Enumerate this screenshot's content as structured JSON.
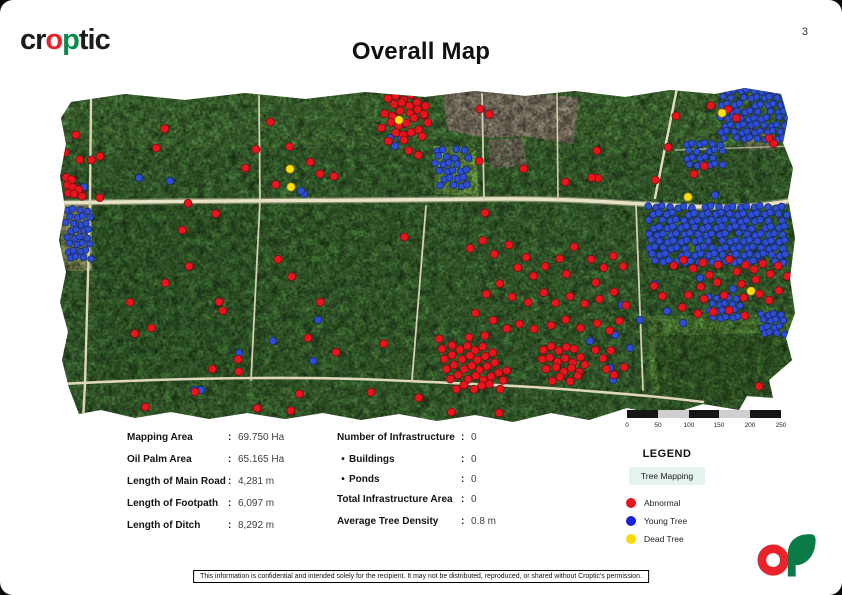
{
  "page": {
    "number": "3"
  },
  "header": {
    "logo": {
      "pre": "cr",
      "o": "o",
      "p": "p",
      "post": "tic"
    },
    "title": "Overall Map"
  },
  "ui": {
    "colon": ":",
    "bullet": "•"
  },
  "scalebar": {
    "labels": [
      "0",
      "50",
      "100",
      "150",
      "200",
      "250"
    ]
  },
  "stats_left": [
    {
      "label": "Mapping Area",
      "value": "69.750 Ha"
    },
    {
      "label": "Oil Palm Area",
      "value": "65.165 Ha"
    },
    {
      "label": "Length of Main Road",
      "value": "4,281 m"
    },
    {
      "label": "Length of Footpath",
      "value": "6,097 m"
    },
    {
      "label": "Length of Ditch",
      "value": "8,292 m"
    }
  ],
  "stats_right": [
    {
      "label": "Number of Infrastructure",
      "value": "0"
    },
    {
      "label": "Buildings",
      "value": "0"
    },
    {
      "label": "Ponds",
      "value": "0"
    },
    {
      "label": "Total Infrastructure Area",
      "value": "0"
    },
    {
      "label": "Average Tree Density",
      "value": "0.8 m"
    }
  ],
  "legend": {
    "title": "LEGEND",
    "group_label": "Tree Mapping",
    "group_bg": "#e4f3ee",
    "items": [
      {
        "label": "Abnormal",
        "color": "#e8151d"
      },
      {
        "label": "Young Tree",
        "color": "#1a22e0"
      },
      {
        "label": "Dead Tree",
        "color": "#ffd900"
      }
    ]
  },
  "footer": {
    "disclaimer": "This information is confidential and intended solely for the recipient. It may not be distributed, reproduced, or shared without Croptic's permission."
  },
  "map": {
    "colors": {
      "abnormal": "#e8151d",
      "abnormal_edge": "#7e0a0f",
      "young": "#2e4fd2",
      "young_edge": "#16277f",
      "dead": "#ffe10a",
      "dead_edge": "#c7a500"
    },
    "red": [
      [
        22,
        48
      ],
      [
        9,
        65
      ],
      [
        24,
        72
      ],
      [
        36,
        72
      ],
      [
        45,
        68
      ],
      [
        110,
        40
      ],
      [
        102,
        59
      ],
      [
        8,
        64
      ],
      [
        10,
        90
      ],
      [
        16,
        92
      ],
      [
        12,
        97
      ],
      [
        18,
        99
      ],
      [
        24,
        101
      ],
      [
        14,
        104
      ],
      [
        20,
        107
      ],
      [
        26,
        109
      ],
      [
        44,
        110
      ],
      [
        215,
        34
      ],
      [
        201,
        61
      ],
      [
        235,
        58
      ],
      [
        256,
        73
      ],
      [
        266,
        87
      ],
      [
        278,
        89
      ],
      [
        220,
        97
      ],
      [
        190,
        80
      ],
      [
        333,
        10
      ],
      [
        341,
        7
      ],
      [
        349,
        11
      ],
      [
        357,
        8
      ],
      [
        338,
        17
      ],
      [
        346,
        15
      ],
      [
        354,
        18
      ],
      [
        362,
        14
      ],
      [
        330,
        25
      ],
      [
        338,
        27
      ],
      [
        346,
        24
      ],
      [
        354,
        26
      ],
      [
        362,
        22
      ],
      [
        370,
        18
      ],
      [
        336,
        34
      ],
      [
        344,
        37
      ],
      [
        352,
        34
      ],
      [
        360,
        31
      ],
      [
        368,
        28
      ],
      [
        340,
        45
      ],
      [
        348,
        47
      ],
      [
        356,
        44
      ],
      [
        364,
        41
      ],
      [
        334,
        52
      ],
      [
        350,
        53
      ],
      [
        366,
        49
      ],
      [
        372,
        35
      ],
      [
        326,
        40
      ],
      [
        369,
        26
      ],
      [
        354,
        62
      ],
      [
        364,
        66
      ],
      [
        426,
        22
      ],
      [
        433,
        27
      ],
      [
        541,
        63
      ],
      [
        510,
        94
      ],
      [
        543,
        90
      ],
      [
        469,
        80
      ],
      [
        425,
        72
      ],
      [
        622,
        29
      ],
      [
        612,
        60
      ],
      [
        536,
        90
      ],
      [
        681,
        30
      ],
      [
        714,
        50
      ],
      [
        719,
        55
      ],
      [
        650,
        77
      ],
      [
        640,
        87
      ],
      [
        672,
        22
      ],
      [
        655,
        18
      ],
      [
        600,
        92
      ],
      [
        133,
        115
      ],
      [
        161,
        125
      ],
      [
        128,
        141
      ],
      [
        431,
        126
      ],
      [
        74,
        215
      ],
      [
        79,
        246
      ],
      [
        110,
        195
      ],
      [
        134,
        178
      ],
      [
        168,
        222
      ],
      [
        158,
        280
      ],
      [
        165,
        215
      ],
      [
        182,
        272
      ],
      [
        183,
        284
      ],
      [
        96,
        240
      ],
      [
        223,
        171
      ],
      [
        237,
        188
      ],
      [
        266,
        213
      ],
      [
        254,
        251
      ],
      [
        280,
        265
      ],
      [
        328,
        256
      ],
      [
        349,
        149
      ],
      [
        415,
        160
      ],
      [
        428,
        152
      ],
      [
        440,
        165
      ],
      [
        455,
        158
      ],
      [
        470,
        170
      ],
      [
        462,
        180
      ],
      [
        478,
        188
      ],
      [
        490,
        178
      ],
      [
        505,
        170
      ],
      [
        512,
        185
      ],
      [
        520,
        160
      ],
      [
        535,
        172
      ],
      [
        548,
        180
      ],
      [
        558,
        168
      ],
      [
        568,
        178
      ],
      [
        445,
        195
      ],
      [
        432,
        205
      ],
      [
        458,
        210
      ],
      [
        472,
        215
      ],
      [
        488,
        205
      ],
      [
        500,
        215
      ],
      [
        515,
        208
      ],
      [
        530,
        215
      ],
      [
        545,
        210
      ],
      [
        560,
        205
      ],
      [
        570,
        218
      ],
      [
        540,
        195
      ],
      [
        420,
        225
      ],
      [
        438,
        232
      ],
      [
        452,
        240
      ],
      [
        465,
        235
      ],
      [
        480,
        242
      ],
      [
        495,
        238
      ],
      [
        510,
        232
      ],
      [
        525,
        240
      ],
      [
        542,
        235
      ],
      [
        555,
        242
      ],
      [
        565,
        232
      ],
      [
        388,
        262
      ],
      [
        396,
        258
      ],
      [
        404,
        262
      ],
      [
        412,
        258
      ],
      [
        420,
        262
      ],
      [
        428,
        258
      ],
      [
        390,
        270
      ],
      [
        398,
        268
      ],
      [
        406,
        272
      ],
      [
        414,
        268
      ],
      [
        422,
        272
      ],
      [
        430,
        268
      ],
      [
        438,
        264
      ],
      [
        392,
        280
      ],
      [
        400,
        278
      ],
      [
        408,
        282
      ],
      [
        416,
        278
      ],
      [
        424,
        282
      ],
      [
        432,
        278
      ],
      [
        440,
        274
      ],
      [
        396,
        290
      ],
      [
        404,
        288
      ],
      [
        412,
        292
      ],
      [
        420,
        288
      ],
      [
        428,
        292
      ],
      [
        436,
        288
      ],
      [
        444,
        284
      ],
      [
        402,
        300
      ],
      [
        410,
        298
      ],
      [
        418,
        302
      ],
      [
        426,
        298
      ],
      [
        434,
        296
      ],
      [
        448,
        292
      ],
      [
        452,
        282
      ],
      [
        446,
        300
      ],
      [
        385,
        252
      ],
      [
        413,
        250
      ],
      [
        429,
        248
      ],
      [
        488,
        262
      ],
      [
        496,
        258
      ],
      [
        504,
        262
      ],
      [
        512,
        258
      ],
      [
        520,
        262
      ],
      [
        486,
        272
      ],
      [
        494,
        270
      ],
      [
        502,
        274
      ],
      [
        510,
        270
      ],
      [
        518,
        274
      ],
      [
        526,
        268
      ],
      [
        492,
        282
      ],
      [
        500,
        280
      ],
      [
        508,
        284
      ],
      [
        516,
        280
      ],
      [
        524,
        284
      ],
      [
        530,
        276
      ],
      [
        498,
        292
      ],
      [
        506,
        290
      ],
      [
        514,
        294
      ],
      [
        522,
        288
      ],
      [
        540,
        262
      ],
      [
        548,
        270
      ],
      [
        556,
        262
      ],
      [
        552,
        280
      ],
      [
        560,
        288
      ],
      [
        568,
        280
      ],
      [
        618,
        178
      ],
      [
        628,
        172
      ],
      [
        638,
        180
      ],
      [
        648,
        174
      ],
      [
        655,
        186
      ],
      [
        664,
        178
      ],
      [
        673,
        172
      ],
      [
        681,
        184
      ],
      [
        690,
        177
      ],
      [
        699,
        181
      ],
      [
        708,
        175
      ],
      [
        716,
        185
      ],
      [
        724,
        179
      ],
      [
        731,
        189
      ],
      [
        700,
        192
      ],
      [
        686,
        196
      ],
      [
        662,
        194
      ],
      [
        646,
        198
      ],
      [
        634,
        206
      ],
      [
        650,
        212
      ],
      [
        668,
        208
      ],
      [
        688,
        210
      ],
      [
        704,
        206
      ],
      [
        714,
        212
      ],
      [
        724,
        202
      ],
      [
        608,
        207
      ],
      [
        600,
        199
      ],
      [
        626,
        220
      ],
      [
        642,
        226
      ],
      [
        658,
        224
      ],
      [
        674,
        222
      ],
      [
        690,
        227
      ],
      [
        91,
        318
      ],
      [
        141,
        305
      ],
      [
        201,
        321
      ],
      [
        235,
        323
      ],
      [
        244,
        306
      ],
      [
        316,
        304
      ],
      [
        364,
        309
      ],
      [
        397,
        323
      ],
      [
        445,
        326
      ],
      [
        703,
        299
      ]
    ],
    "blue": [
      [
        84,
        90
      ],
      [
        115,
        93
      ],
      [
        29,
        99
      ],
      [
        249,
        106
      ],
      [
        246,
        103
      ],
      [
        335,
        50
      ],
      [
        346,
        50
      ],
      [
        340,
        58
      ],
      [
        263,
        232
      ],
      [
        218,
        253
      ],
      [
        258,
        273
      ],
      [
        184,
        265
      ],
      [
        139,
        302
      ],
      [
        146,
        302
      ],
      [
        567,
        217
      ],
      [
        585,
        232
      ],
      [
        560,
        247
      ],
      [
        535,
        253
      ],
      [
        555,
        280
      ],
      [
        558,
        292
      ],
      [
        575,
        260
      ],
      [
        600,
        196
      ],
      [
        678,
        201
      ],
      [
        645,
        190
      ],
      [
        612,
        223
      ],
      [
        628,
        235
      ],
      [
        660,
        107
      ]
    ],
    "yellow": [
      [
        344,
        32
      ],
      [
        235,
        81
      ],
      [
        236,
        99
      ],
      [
        667,
        25
      ],
      [
        633,
        109
      ],
      [
        696,
        203
      ]
    ],
    "blue_clusters": [
      {
        "x": 281,
        "y": 10,
        "cols": 5,
        "rows": 6,
        "dx": 7,
        "dy": 7,
        "r": 3.4,
        "skip": 7
      },
      {
        "x": 381,
        "y": 62,
        "cols": 5,
        "rows": 6,
        "dx": 7,
        "dy": 7,
        "r": 3.4,
        "skip": 6
      },
      {
        "x": 666,
        "y": 3,
        "cols": 11,
        "rows": 8,
        "dx": 6.6,
        "dy": 6.8,
        "r": 3.2,
        "skip": 13
      },
      {
        "x": 631,
        "y": 56,
        "cols": 6,
        "rows": 4,
        "dx": 6.6,
        "dy": 6.8,
        "r": 3.2,
        "skip": 9
      },
      {
        "x": 594,
        "y": 119,
        "cols": 20,
        "rows": 9,
        "dx": 7,
        "dy": 6.8,
        "r": 3.4,
        "skip": 17
      },
      {
        "x": 12,
        "y": 122,
        "cols": 4,
        "rows": 8,
        "dx": 6.5,
        "dy": 6.8,
        "r": 3.2,
        "skip": 7
      },
      {
        "x": 655,
        "y": 210,
        "cols": 5,
        "rows": 4,
        "dx": 6.4,
        "dy": 6.4,
        "r": 3.2,
        "skip": 0
      },
      {
        "x": 706,
        "y": 226,
        "cols": 4,
        "rows": 4,
        "dx": 6.4,
        "dy": 6.4,
        "r": 3.2,
        "skip": 0
      }
    ]
  }
}
